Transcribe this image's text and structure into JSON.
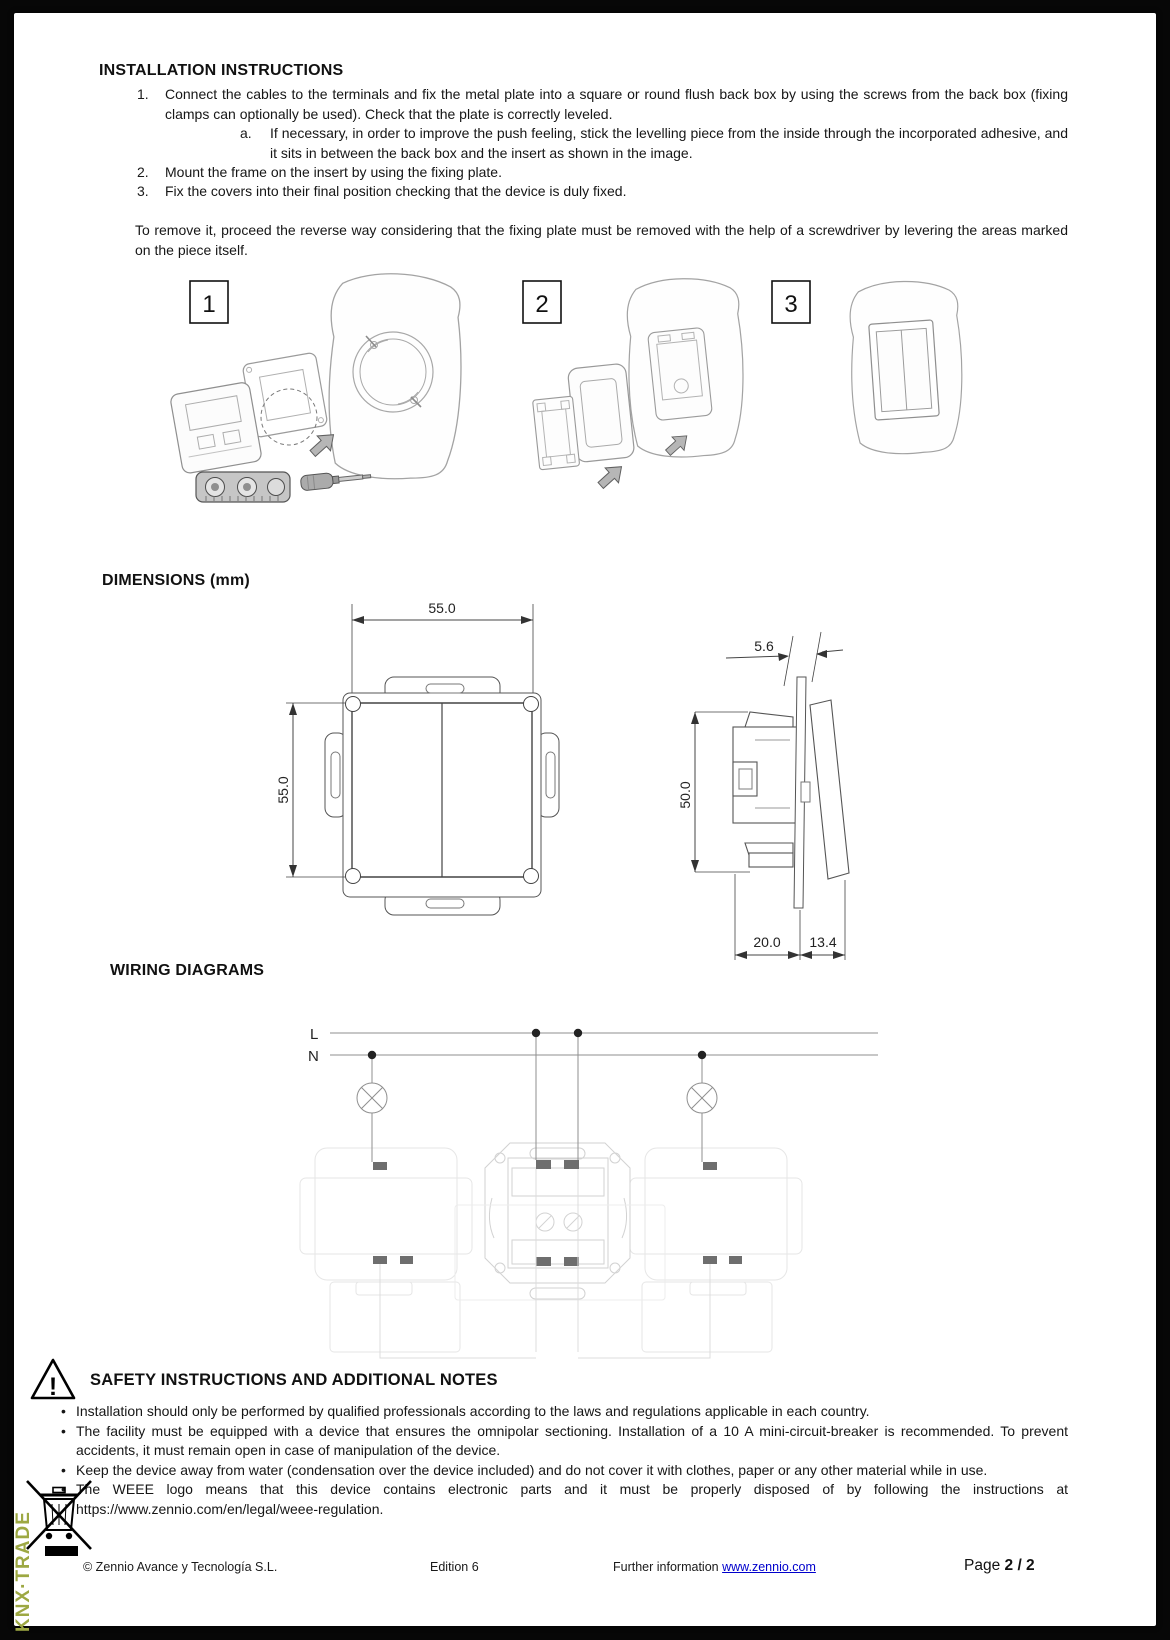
{
  "colors": {
    "side_text_green": "#9da843",
    "link_blue": "#0000cc"
  },
  "installation": {
    "title": "INSTALLATION INSTRUCTIONS",
    "steps": [
      {
        "num": "1.",
        "text": "Connect the cables to the terminals and fix the metal plate into a square or round flush back box by using the screws from the back box (fixing clamps can optionally be used). Check that the plate is correctly leveled."
      },
      {
        "num": "a.",
        "text": "If necessary, in order to improve the push feeling, stick the levelling piece from the inside through the incorporated adhesive, and it sits in between the back box and the insert as shown in the image."
      },
      {
        "num": "2.",
        "text": "Mount the frame on the insert by using the fixing plate."
      },
      {
        "num": "3.",
        "text": "Fix the covers into their final position checking that the device is duly fixed."
      }
    ],
    "removal_note": "To remove it, proceed the reverse way considering that the fixing plate must be removed with the help of a screwdriver by levering the areas marked on the piece itself.",
    "figure_labels": [
      "1",
      "2",
      "3"
    ]
  },
  "dimensions": {
    "title": "DIMENSIONS (mm)",
    "front_width": "55.0",
    "front_height": "55.0",
    "frame_thickness": "5.6",
    "insert_height": "50.0",
    "depth_back": "20.0",
    "depth_front": "13.4"
  },
  "wiring": {
    "title": "WIRING DIAGRAMS",
    "line_live": "L",
    "line_neutral": "N"
  },
  "safety": {
    "title": "SAFETY INSTRUCTIONS AND ADDITIONAL NOTES",
    "warning_symbol": "!",
    "bullets": [
      "Installation should only be performed by qualified professionals according to the laws and regulations applicable in each country.",
      "The facility must be equipped with a device that ensures the omnipolar sectioning. Installation of a 10 A mini-circuit-breaker is recommended. To prevent accidents, it must remain open in case of manipulation of the device.",
      "Keep the device away from water (condensation over the device included) and do not cover it with clothes, paper or any other material while in use.",
      "The WEEE logo means that this device contains electronic parts and it must be properly disposed of by following the instructions at https://www.zennio.com/en/legal/weee-regulation."
    ]
  },
  "footer": {
    "copyright": "© Zennio Avance y Tecnología S.L.",
    "edition": "Edition 6",
    "further_label": "Further information",
    "further_link": "www.zennio.com",
    "page_label": "Page",
    "page_value": "2 / 2"
  },
  "side_text": "KNX·TRADE"
}
